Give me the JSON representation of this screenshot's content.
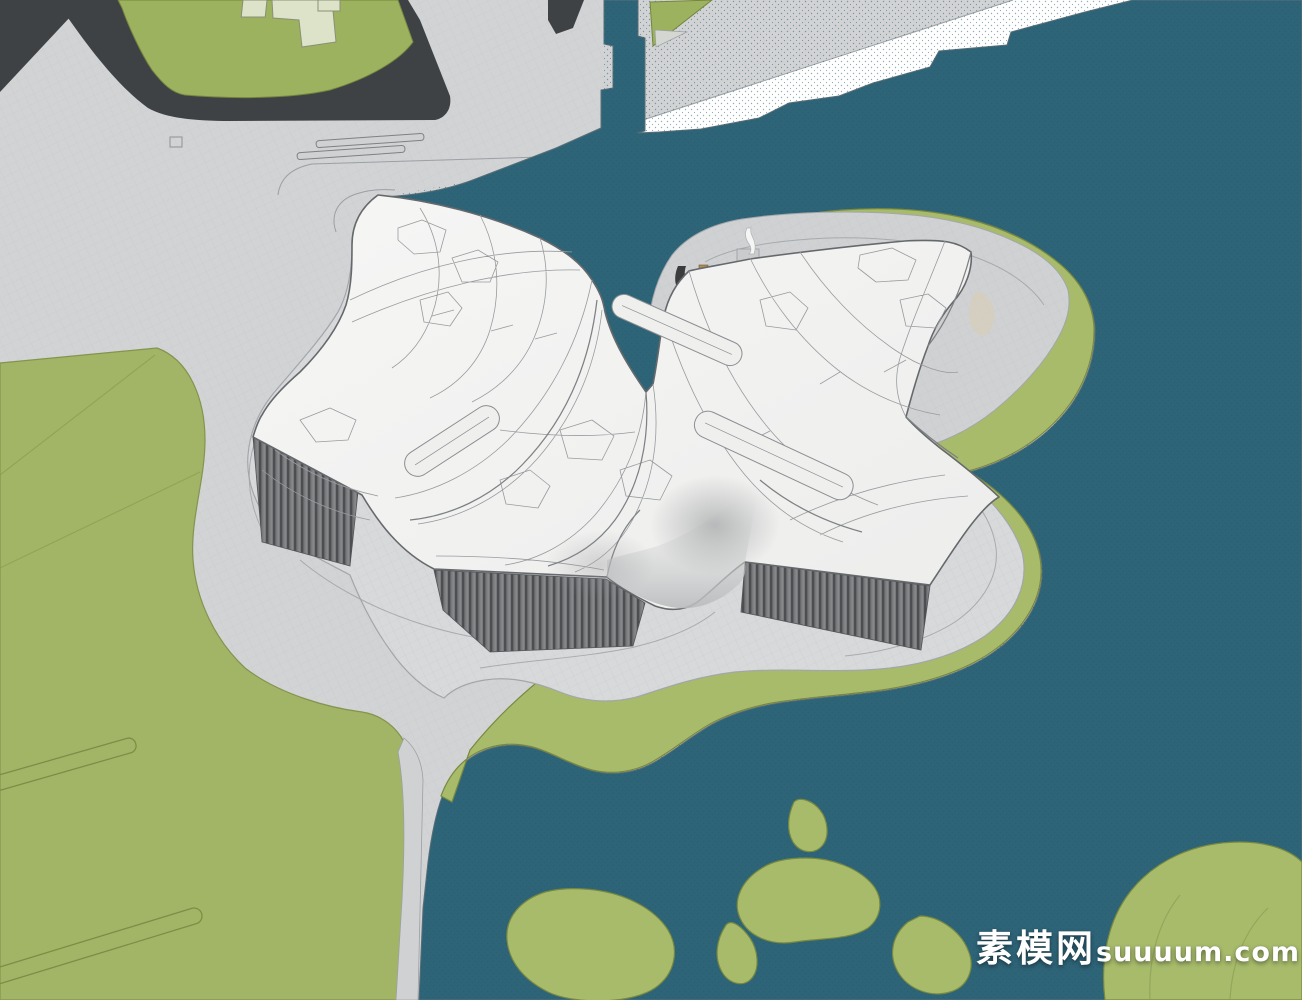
{
  "watermark": {
    "site_name_cjk": "素模网",
    "site_domain": "suuuum.com",
    "full_text": "素模网suuuum.com"
  },
  "scene": {
    "type": "3d-architectural-model-render",
    "subject": "organic butterfly-roof waterfront museum building with terraced plinth, lawn, canal and sea"
  },
  "palette": {
    "water": "#2e6478",
    "plaza": "#d2d3d5",
    "grid": "#bcbfc3",
    "lawn": "#a2b566",
    "green": "#a7bb6b",
    "greenedge": "#78883f",
    "plot": "#9db25e",
    "dark": "#3f4245",
    "shore": "#ffffff",
    "roof": "#f4f4f3",
    "roofline": "#989b9e",
    "fold": "#7e8184",
    "roofedge": "#66696c",
    "louver": "#77797b",
    "louverstripe": "#45474a",
    "plinth": "#d8d9db",
    "plinthline": "#a3a6a9",
    "court": "#cfd1d3",
    "block": "#dde3c8",
    "path": "#cfd1d3",
    "wm": "#ffffff"
  }
}
